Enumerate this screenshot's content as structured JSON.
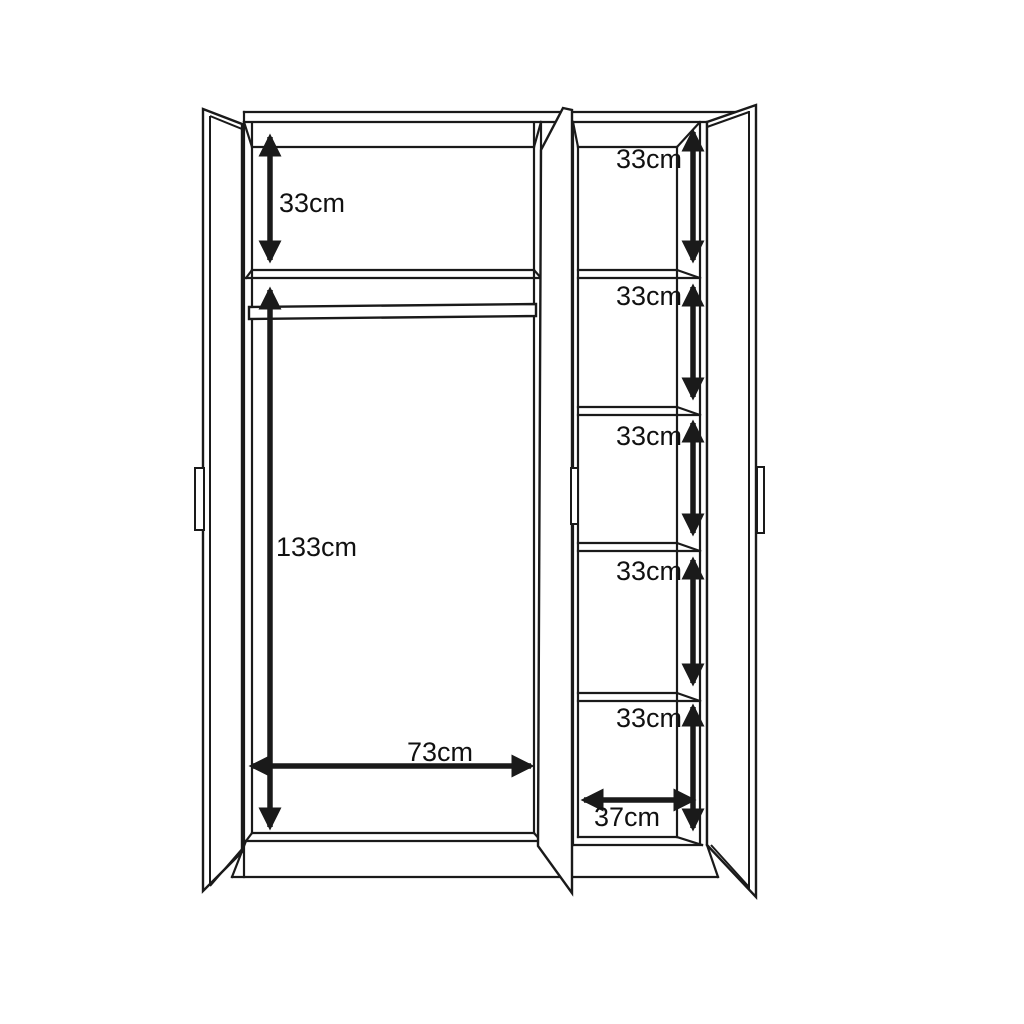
{
  "diagram": {
    "colors": {
      "background": "#ffffff",
      "line": "#1a1a1a",
      "text": "#111111"
    },
    "dimensions": {
      "left_top_shelf": "33cm",
      "left_hanging": "133cm",
      "left_width": "73cm",
      "right_cells": [
        "33cm",
        "33cm",
        "33cm",
        "33cm",
        "33cm"
      ],
      "right_width": "37cm"
    }
  }
}
